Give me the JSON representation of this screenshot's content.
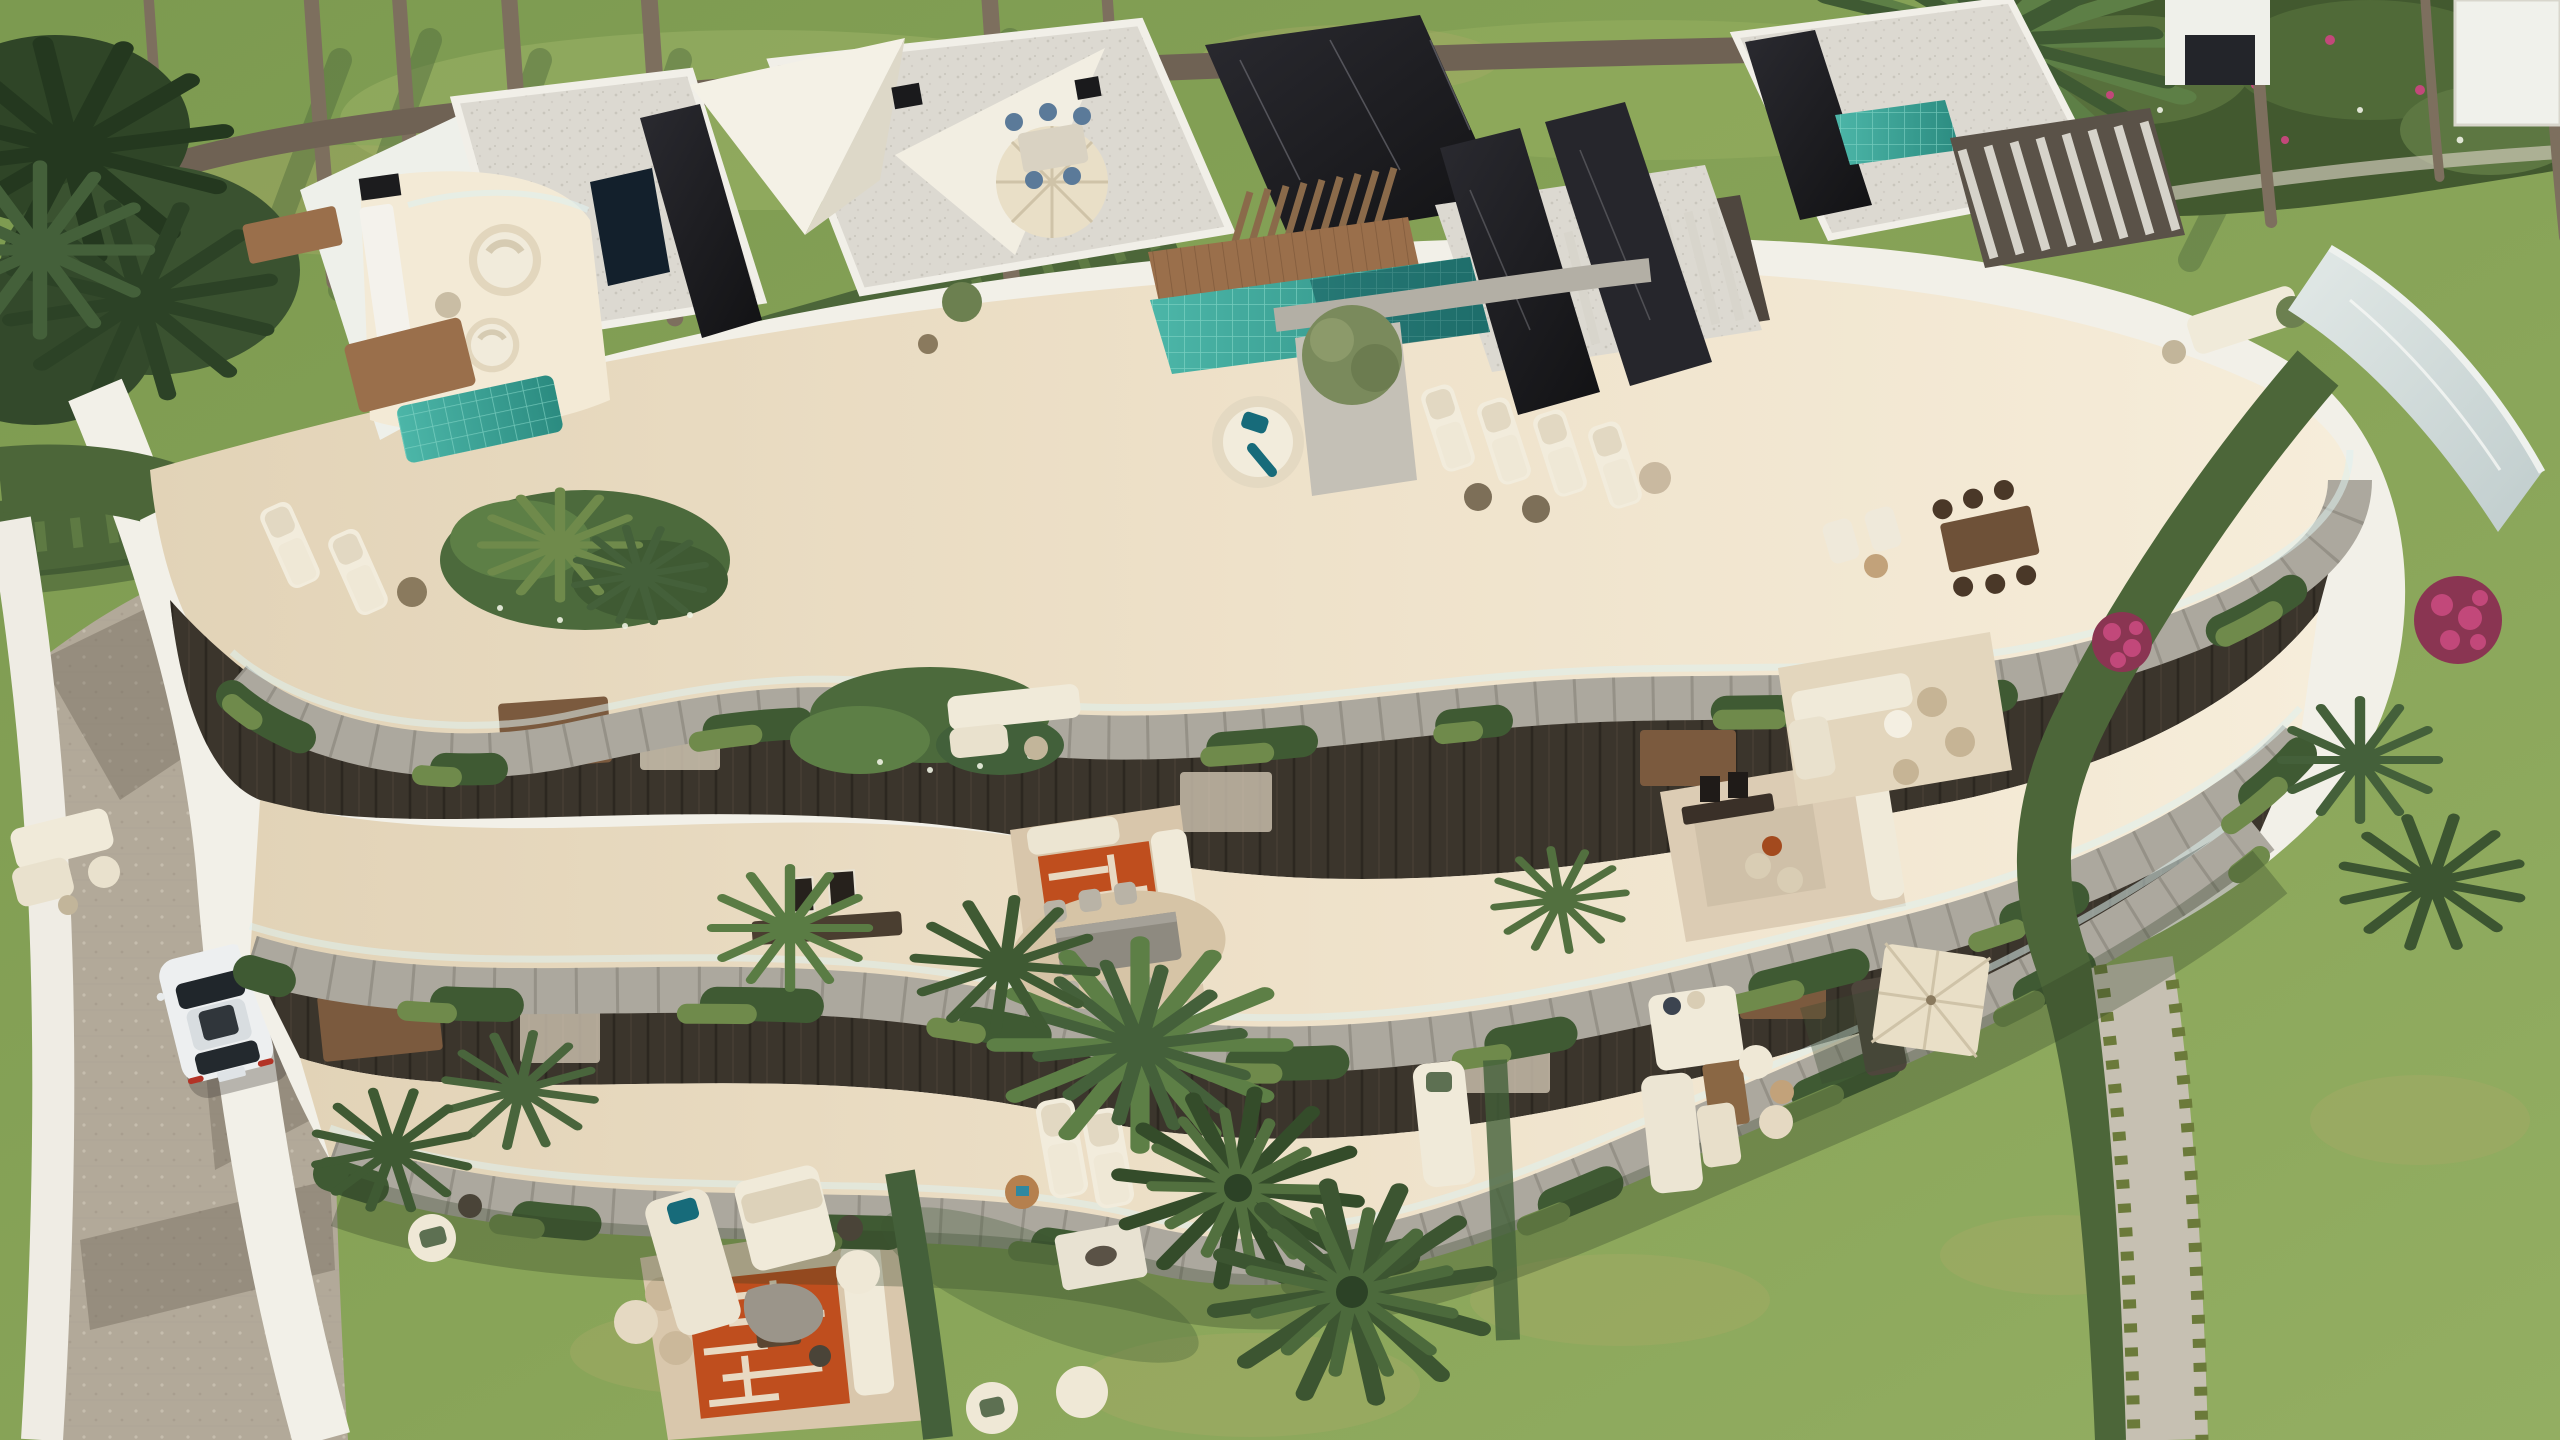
{
  "scene": {
    "description": "Aerial 3D render of a curved modern terraced apartment building with rooftop terraces, plunge pools, cascading planters, gardens, lawns, palm trees, a driveway with a white car, hedges and a gravel path",
    "objects": [
      "lawn",
      "hedge",
      "palm-tree",
      "flower-bed",
      "apartment-building",
      "rooftop-terrace",
      "shade-sail",
      "parasol",
      "pergola",
      "wooden-deck-bridge",
      "plunge-pool",
      "sun-lounger",
      "round-daybed",
      "outdoor-sofa",
      "outdoor-dining-set",
      "open-air-living-room",
      "patterned-rug",
      "cascading-planter",
      "glass-balustrade",
      "stone-fascia",
      "driveway",
      "white-suv",
      "gravel-path",
      "bougainvillea"
    ]
  },
  "palette": {
    "grass_dark": "#7c9a50",
    "grass_light": "#93ae62",
    "grass_dry": "#a8ab67",
    "hedge": "#4c6639",
    "foliage": "#5d7f46",
    "foliage_dark": "#344c2a",
    "trunk": "#7d6f5e",
    "wall_white": "#f2f0e8",
    "roof": "#dcd9d1",
    "stone": "#aca89e",
    "floor_light": "#f6edda",
    "floor_shade": "#e2d3b7",
    "recess": "#3b352c",
    "marble": "#1e1e22",
    "pool_teal": "#3aa79b",
    "pool_pale": "#ccd6d5",
    "wood": "#9a6f4b",
    "drive": "#b2a999",
    "umbrella": "#e9dfc7",
    "car": "#edeff0",
    "rug": "#bf4e1e",
    "flower": "#c2487a",
    "gravel": "#c6c0b2",
    "cushion": "#176b7a"
  }
}
